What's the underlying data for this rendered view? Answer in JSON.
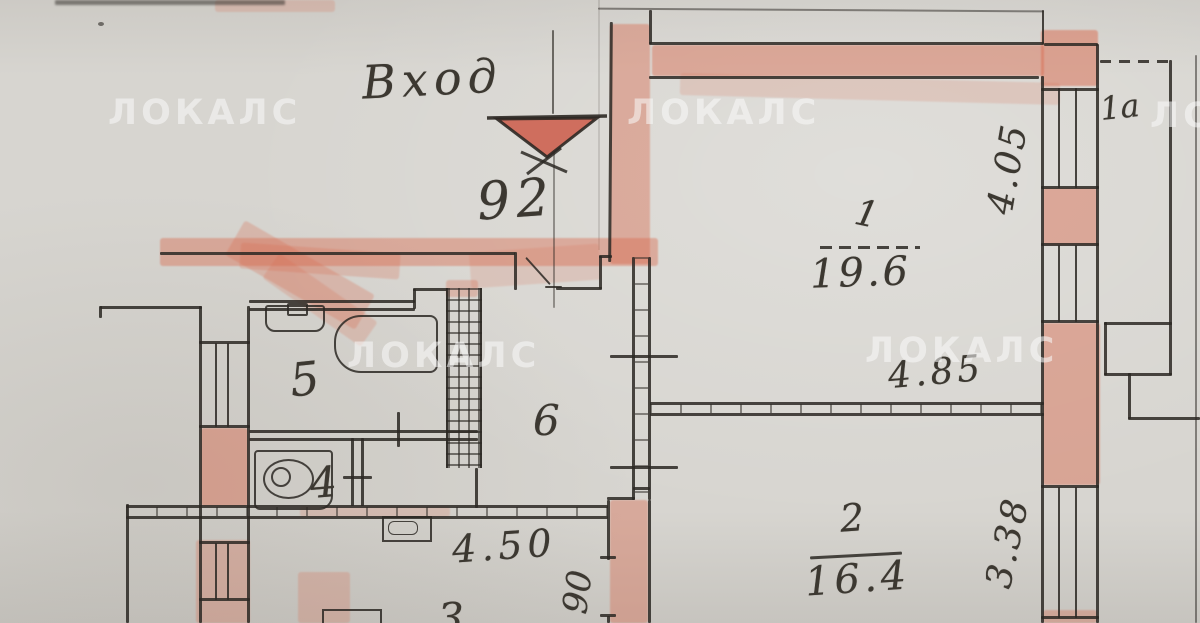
{
  "watermark": {
    "text": "ЛОКАЛС"
  },
  "entrance": {
    "label": "Вход",
    "axis_number": "92"
  },
  "rooms": {
    "r1": {
      "number": "1",
      "area": "19.6"
    },
    "r2": {
      "number": "2",
      "area": "16.4"
    },
    "r3": {
      "number": "3"
    },
    "r4": {
      "number": "4"
    },
    "r5": {
      "number": "5"
    },
    "r6": {
      "number": "6"
    },
    "balcony": {
      "number": "1а"
    }
  },
  "dims": {
    "room1_depth": "4.05",
    "room2_width": "4.85",
    "room2_depth": "3.38",
    "room3_width": "4.50",
    "door_width": "90"
  },
  "colors": {
    "highlight": "#d96a4e",
    "ink": "#2c2823",
    "paper": "#d7d5d0",
    "watermark": "#fafafa"
  }
}
